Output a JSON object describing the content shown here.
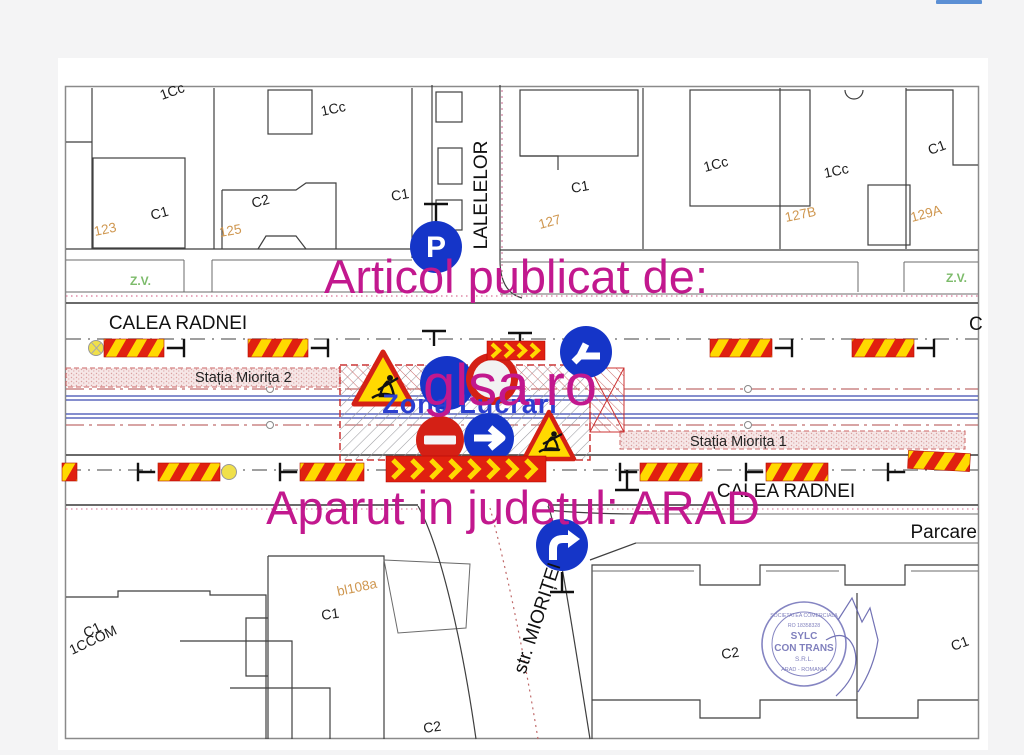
{
  "page": {
    "background": "#f4f4f5",
    "topbar_fragment_color": "#5b8fd4"
  },
  "watermark": {
    "color": "#c2188e",
    "line1": "Articol publicat de:",
    "line2": "glsa.ro",
    "line3": "Aparut in judetul: ARAD"
  },
  "map": {
    "street_top": "CALEA RADNEI",
    "street_bottom": "CALEA RADNEI",
    "street_right_partial": "C",
    "street_vertical": "LALELELOR",
    "street_diagonal": "str. MIORIȚEI",
    "parking_area": "Parcare",
    "station_2": "Stația Miorița 2",
    "station_1": "Stația Miorița 1",
    "work_zone": "Zona Lucrari",
    "green_zone_left": "Z.V.",
    "green_zone_right": "Z.V.",
    "parking_sign_letter": "P",
    "parcels": {
      "p1": "1Cc",
      "p2": "C1",
      "p3": "C2",
      "p4": "1Cc",
      "p5": "C1",
      "p6": "C1",
      "p7": "1Cc",
      "p8": "1Cc",
      "p9": "C1",
      "p10": "C1",
      "p11": "1CCOM",
      "p12": "C1",
      "p13": "C2",
      "p14": "C2",
      "p15": "C1"
    },
    "addresses": {
      "n123": "123",
      "n125": "125",
      "n127": "127",
      "n127b": "127B",
      "n129a": "129A",
      "bl": "bl108a"
    },
    "colors": {
      "tram_line": "#3c4bb0",
      "work_zone_border": "#cc3333",
      "station_band": "#f6e7e7",
      "address_text": "#cf9750",
      "green_zone_text": "#7cbb6a",
      "zone_label": "#2b3fd0",
      "sign_blue": "#1535c8",
      "sign_red": "#d42015",
      "barrier_red": "#e02010",
      "barrier_yellow": "#ffd900"
    }
  },
  "stamp": {
    "color": "#6a6ab2",
    "ring_top": "SOCIETATEA COMERCIALA",
    "reg_no": "RO 18358328",
    "name_line1": "SYLC",
    "name_line2": "CON TRANS",
    "name_line3": "S.R.L.",
    "ring_bottom": "ARAD - ROMANIA"
  }
}
